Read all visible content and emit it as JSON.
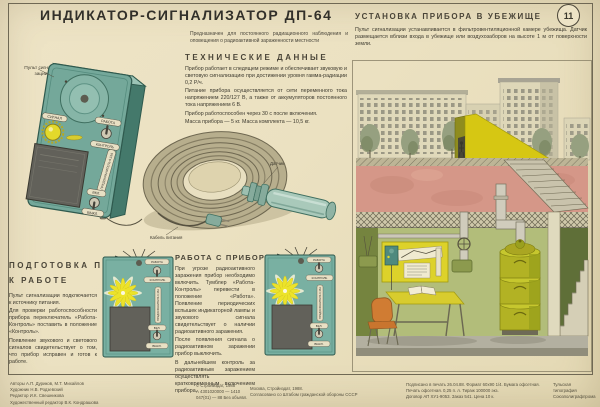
{
  "poster": {
    "number": "11",
    "title": "ИНДИКАТОР-СИГНАЛИЗАТОР ДП-64",
    "intro": "Предназначен для постоянного радиационного наблюдения и оповещения о радиоактивной зараженности местности"
  },
  "tech": {
    "heading": "ТЕХНИЧЕСКИЕ ДАННЫЕ",
    "paragraphs": [
      "Прибор работает в следящем режиме и обеспечивает звуковую и световую сигнализацию при достижении уровня гамма-радиации 0,2 Р/ч.",
      "Питание прибора осуществляется от сети переменного тока напряжением 220/127 В, а также от аккумуляторов постоянного тока напряжением 6 В.",
      "Прибор работоспособен через 30 с после включения.",
      "Масса прибора — 5 кг. Масса комплекта — 10,5 кг."
    ]
  },
  "shelter": {
    "heading": "УСТАНОВКА ПРИБОРА В УБЕЖИЩЕ",
    "text": "Пульт сигнализации устанавливается в фильтровентиляционной камере убежища. Датчик размещается вблизи входа в убежище или воздухозаборов на высоте 1 м от поверхности земли."
  },
  "device": {
    "console_label": "Пульт сигнали- зации",
    "signal": "СИГНАЛ",
    "work": "РАБОТА",
    "control": "КОНТРОЛЬ",
    "fuse": "ПРЕДОХРАНИТЕЛЬ 0,15А",
    "on": "ВКЛ.",
    "off": "ВЫКЛ.",
    "sensor_label": "Датчик",
    "cable_label": "Кабель питания"
  },
  "prep": {
    "heading_line1": "ПОДГОТОВКА ПРИБОРА",
    "heading_line2": "К РАБОТЕ",
    "paragraphs": [
      "Пульт сигнализации подключается к источнику питания.",
      "Для проверки работоспособности прибора переключатель «Работа-Контроль» поставить в положение «Контроль».",
      "Появление звукового и светового сигналов свидетельствует о том, что прибор исправен и готов к работе."
    ]
  },
  "operation": {
    "heading": "РАБОТА С ПРИБОРОМ",
    "paragraphs": [
      "При угрозе радиоактивного заражения прибор необходимо включить. Тумблер «Работа-Контроль» перевести в положение «Работа». Появление периодических вспышек индикаторной лампы и звукового сигнала свидетельствует о наличии радиоактивного заражения.",
      "После появления сигнала о радиоактивном заражении прибор выключить.",
      "В дальнейшем контроль за радиоактивным заражением осуществлять кратковременным включением прибора."
    ]
  },
  "credits": {
    "authors_line1": "Авторы А.П. Дуриков, М.Т. Михайлов",
    "authors_line2": "Художник Н.В. Родзевский",
    "authors_line3": "Редактор И.К. Свешникова",
    "authors_line4": "Художественный редактор В.К. Кондрашова",
    "copyright": "© Стройиздат, 1988",
    "code_line1": "А 4301020000 — 1410",
    "code_line2": "047(01) — 88   Без объявл.",
    "city_line1": "Москва, Стройиздат, 1988.",
    "city_line2": "Согласовано со Штабом гражданской обороны СССР",
    "print_line1": "Подписано в печать 26.04.88. Формат 60х90 1/4. Бумага офсетная.",
    "print_line2": "Печать офсетная. 0,25 п. л. Тираж 100000 экз.",
    "print_line3": "Договор АП ХУ1-9053. Заказ 541. Цена 10 к.",
    "printer_line1": "Тульская",
    "printer_line2": "типография",
    "printer_line3": "Союзполиграфпрома"
  },
  "colors": {
    "paper": "#ebe1c1",
    "device_teal": "#74a89a",
    "panel_yellow": "#ddd22a",
    "signal_yellow": "#ece32a",
    "earth_pink": "#d59788",
    "wall_green": "#b2bd7a",
    "chair_orange": "#d07c33"
  }
}
